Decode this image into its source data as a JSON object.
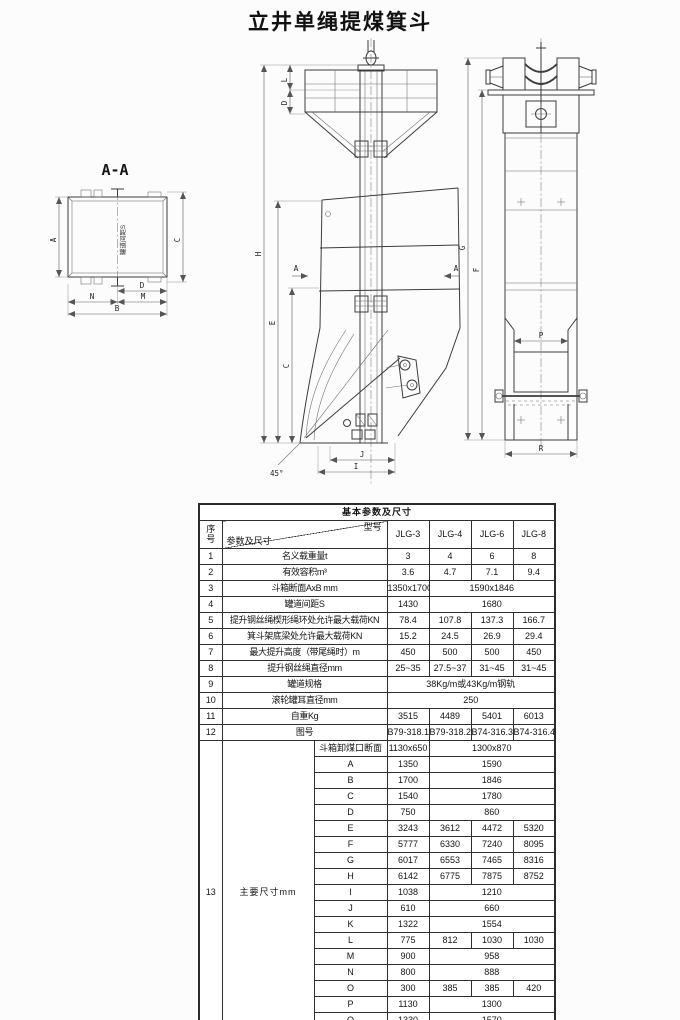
{
  "page": {
    "title": "立井单绳提煤箕斗"
  },
  "drawings": {
    "section_title": "A-A",
    "rail_text": "罐道间距S",
    "angle": "45°",
    "dims": {
      "A": "A",
      "B": "B",
      "C": "C",
      "D": "D",
      "E": "E",
      "F": "F",
      "G": "G",
      "H": "H",
      "I": "I",
      "J": "J",
      "L": "L",
      "M": "M",
      "N": "N",
      "P": "P",
      "R": "R"
    }
  },
  "table": {
    "title": "基本参数及尺寸",
    "no_header": "序号",
    "param_header": "参数及尺寸",
    "model_header": "型号",
    "models": [
      "JLG-3",
      "JLG-4",
      "JLG-6",
      "JLG-8"
    ],
    "rows": [
      {
        "no": "1",
        "label": "名义载重量t",
        "cells": [
          [
            "3",
            1
          ],
          [
            "4",
            1
          ],
          [
            "6",
            1
          ],
          [
            "8",
            1
          ]
        ]
      },
      {
        "no": "2",
        "label": "有效容积m³",
        "cells": [
          [
            "3.6",
            1
          ],
          [
            "4.7",
            1
          ],
          [
            "7.1",
            1
          ],
          [
            "9.4",
            1
          ]
        ]
      },
      {
        "no": "3",
        "label": "斗箱断面AxB mm",
        "cells": [
          [
            "1350x1700",
            1
          ],
          [
            "1590x1846",
            3
          ]
        ]
      },
      {
        "no": "4",
        "label": "罐道间距S",
        "cells": [
          [
            "1430",
            1
          ],
          [
            "1680",
            3
          ]
        ]
      },
      {
        "no": "5",
        "label": "提升钢丝绳楔形绳环处允许最大载荷KN",
        "cells": [
          [
            "78.4",
            1
          ],
          [
            "107.8",
            1
          ],
          [
            "137.3",
            1
          ],
          [
            "166.7",
            1
          ]
        ]
      },
      {
        "no": "6",
        "label": "箕斗架底梁处允许最大载荷KN",
        "cells": [
          [
            "15.2",
            1
          ],
          [
            "24.5",
            1
          ],
          [
            "26.9",
            1
          ],
          [
            "29.4",
            1
          ]
        ]
      },
      {
        "no": "7",
        "label": "最大提升高度（带尾绳时）m",
        "cells": [
          [
            "450",
            1
          ],
          [
            "500",
            1
          ],
          [
            "500",
            1
          ],
          [
            "450",
            1
          ]
        ]
      },
      {
        "no": "8",
        "label": "提升钢丝绳直径mm",
        "cells": [
          [
            "25~35",
            1
          ],
          [
            "27.5~37",
            1
          ],
          [
            "31~45",
            1
          ],
          [
            "31~45",
            1
          ]
        ]
      },
      {
        "no": "9",
        "label": "罐道规格",
        "cells": [
          [
            "38Kg/m或43Kg/m钢轨",
            4
          ]
        ]
      },
      {
        "no": "10",
        "label": "滚轮罐耳直径mm",
        "cells": [
          [
            "250",
            4
          ]
        ]
      },
      {
        "no": "11",
        "label": "自重Kg",
        "cells": [
          [
            "3515",
            1
          ],
          [
            "4489",
            1
          ],
          [
            "5401",
            1
          ],
          [
            "6013",
            1
          ]
        ]
      },
      {
        "no": "12",
        "label": "图号",
        "cells": [
          [
            "B79-318.1",
            1
          ],
          [
            "B79-318.2",
            1
          ],
          [
            "B74-316.3",
            1
          ],
          [
            "B74-316.4",
            1
          ]
        ]
      }
    ],
    "group13": {
      "no": "13",
      "label": "主要尺寸mm",
      "subrows": [
        {
          "name": "斗箱卸煤口断面",
          "cells": [
            [
              "1130x650",
              1
            ],
            [
              "1300x870",
              3
            ]
          ]
        },
        {
          "name": "A",
          "cells": [
            [
              "1350",
              1
            ],
            [
              "1590",
              3
            ]
          ]
        },
        {
          "name": "B",
          "cells": [
            [
              "1700",
              1
            ],
            [
              "1846",
              3
            ]
          ]
        },
        {
          "name": "C",
          "cells": [
            [
              "1540",
              1
            ],
            [
              "1780",
              3
            ]
          ]
        },
        {
          "name": "D",
          "cells": [
            [
              "750",
              1
            ],
            [
              "860",
              3
            ]
          ]
        },
        {
          "name": "E",
          "cells": [
            [
              "3243",
              1
            ],
            [
              "3612",
              1
            ],
            [
              "4472",
              1
            ],
            [
              "5320",
              1
            ]
          ]
        },
        {
          "name": "F",
          "cells": [
            [
              "5777",
              1
            ],
            [
              "6330",
              1
            ],
            [
              "7240",
              1
            ],
            [
              "8095",
              1
            ]
          ]
        },
        {
          "name": "G",
          "cells": [
            [
              "6017",
              1
            ],
            [
              "6553",
              1
            ],
            [
              "7465",
              1
            ],
            [
              "8316",
              1
            ]
          ]
        },
        {
          "name": "H",
          "cells": [
            [
              "6142",
              1
            ],
            [
              "6775",
              1
            ],
            [
              "7875",
              1
            ],
            [
              "8752",
              1
            ]
          ]
        },
        {
          "name": "I",
          "cells": [
            [
              "1038",
              1
            ],
            [
              "1210",
              3
            ]
          ]
        },
        {
          "name": "J",
          "cells": [
            [
              "610",
              1
            ],
            [
              "660",
              3
            ]
          ]
        },
        {
          "name": "K",
          "cells": [
            [
              "1322",
              1
            ],
            [
              "1554",
              3
            ]
          ]
        },
        {
          "name": "L",
          "cells": [
            [
              "775",
              1
            ],
            [
              "812",
              1
            ],
            [
              "1030",
              1
            ],
            [
              "1030",
              1
            ]
          ]
        },
        {
          "name": "M",
          "cells": [
            [
              "900",
              1
            ],
            [
              "958",
              3
            ]
          ]
        },
        {
          "name": "N",
          "cells": [
            [
              "800",
              1
            ],
            [
              "888",
              3
            ]
          ]
        },
        {
          "name": "O",
          "cells": [
            [
              "300",
              1
            ],
            [
              "385",
              1
            ],
            [
              "385",
              1
            ],
            [
              "420",
              1
            ]
          ]
        },
        {
          "name": "P",
          "cells": [
            [
              "1130",
              1
            ],
            [
              "1300",
              3
            ]
          ]
        },
        {
          "name": "Q",
          "cells": [
            [
              "1330",
              1
            ],
            [
              "1570",
              3
            ]
          ]
        },
        {
          "name": "R",
          "cells": [
            [
              "1400",
              1
            ],
            [
              "1600",
              3
            ]
          ]
        }
      ]
    }
  }
}
